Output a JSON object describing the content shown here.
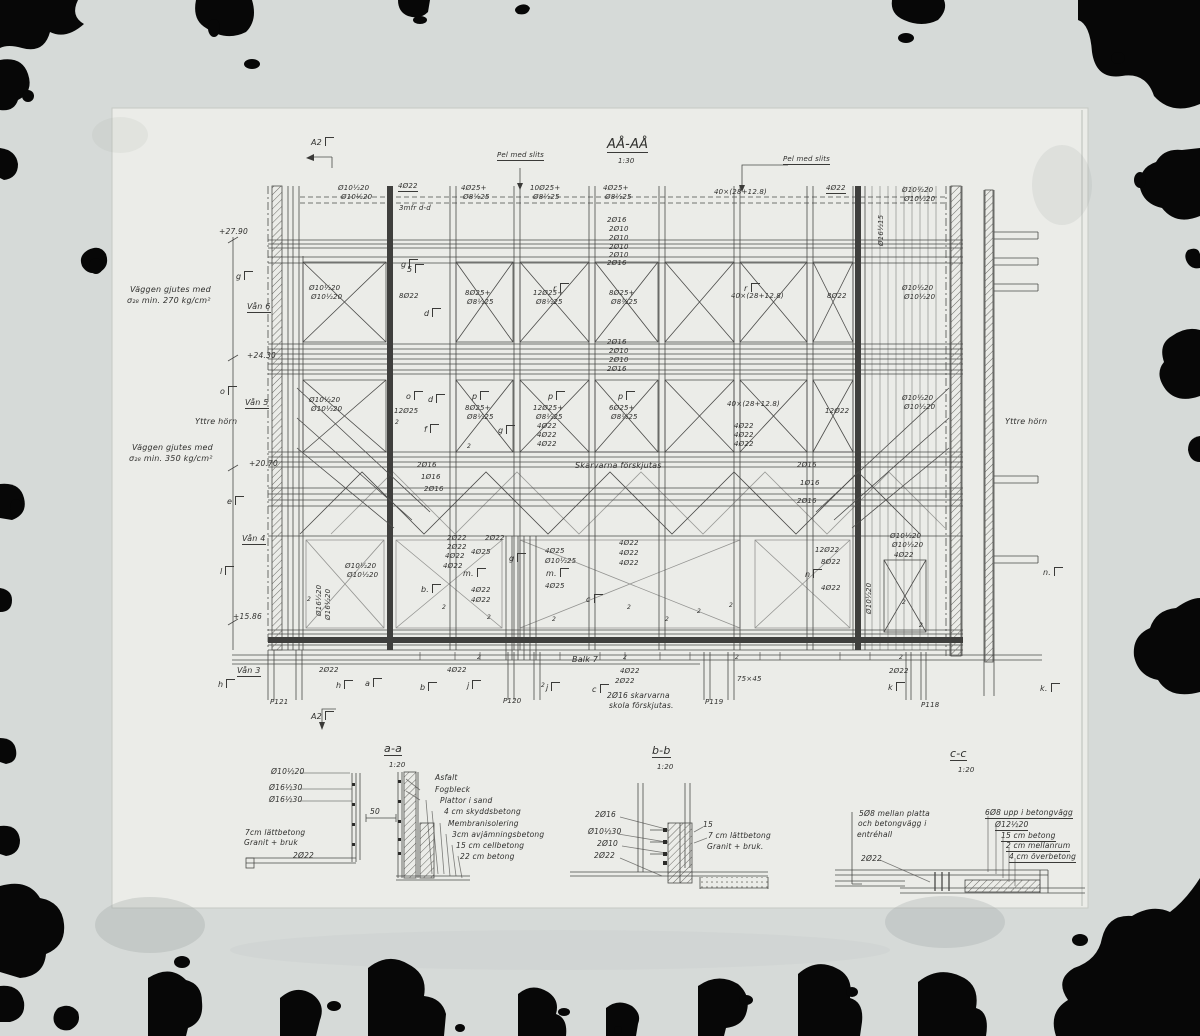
{
  "main": {
    "title": "AÅ-AÅ",
    "scale": "1:30",
    "pel_left": "Pel med slits",
    "pel_right": "Pel med slits",
    "note270_1": "Väggen gjutes med",
    "note270_2": "σ₂₈ min. 270 kg/cm²",
    "note350_1": "Väggen gjutes med",
    "note350_2": "σ₂₈ min. 350 kg/cm²",
    "yttre_left": "Yttre hörn",
    "yttre_right": "Yttre hörn",
    "skarv": "Skarvarna förskjutas",
    "balk": "Balk 7",
    "balk_note1": "2Ø16 skarvarna",
    "balk_note2": "skola förskjutas.",
    "balk_dim": "75×45",
    "elevations": [
      "+27.90",
      "+24.30",
      "+20.70",
      "+15.86"
    ],
    "floors": [
      "Vån 6",
      "Vån 5",
      "Vån 4",
      "Vån 3"
    ],
    "piers": [
      "P121",
      "P120",
      "P119",
      "P118"
    ],
    "markers": [
      "A2",
      "A2",
      "g",
      "o",
      "e",
      "l",
      "h",
      "h",
      "a",
      "b",
      "j",
      "j",
      "c",
      "k",
      "k.",
      "n",
      "n.",
      "g",
      "d",
      "r",
      "r",
      "o",
      "d",
      "p",
      "p",
      "p",
      "f",
      "g",
      "m.",
      "m.",
      "b.",
      "c",
      "g",
      "5"
    ],
    "ann": [
      "Ø10½20",
      "Ø10½20",
      "4Ø22",
      "3mfr d-d",
      "4Ø25+",
      "Ø8½25",
      "10Ø25+",
      "Ø8½25",
      "4Ø25+",
      "Ø8½25",
      "40×(28+12.8)",
      "4Ø22",
      "Ø10½20",
      "Ø10½20",
      "2Ø16",
      "2Ø10",
      "2Ø10",
      "2Ø10",
      "2Ø10",
      "2Ø16",
      "Ø10½20",
      "Ø10½20",
      "8Ø22",
      "8Ø25+",
      "Ø8½25",
      "12Ø25+",
      "Ø8½25",
      "8Ø25+",
      "Ø8½25",
      "40×(28+12.8)",
      "8Ø22",
      "Ø10½20",
      "Ø10½20",
      "2Ø16",
      "2Ø10",
      "2Ø10",
      "2Ø16",
      "Ø10½20",
      "Ø10½20",
      "12Ø25",
      "8Ø25+",
      "Ø8½25",
      "12Ø25+",
      "Ø8½25",
      "4Ø22",
      "4Ø22",
      "4Ø22",
      "6Ø25+",
      "Ø8½25",
      "40×(28+12.8)",
      "12Ø22",
      "Ø10½20",
      "Ø10½20",
      "4Ø22",
      "4Ø22",
      "4Ø22",
      "2Ø16",
      "1Ø16",
      "2Ø16",
      "2Ø16",
      "1Ø16",
      "2Ø16",
      "2Ø22",
      "2Ø22",
      "4Ø22",
      "4Ø22",
      "2Ø22",
      "4Ø25",
      "4Ø25",
      "Ø10½25",
      "4Ø25",
      "4Ø22",
      "4Ø22",
      "4Ø22",
      "4Ø22",
      "4Ø22",
      "12Ø22",
      "8Ø22",
      "4Ø22",
      "Ø10½20",
      "Ø10½20",
      "4Ø22",
      "Ø10½20",
      "Ø10½20",
      "2Ø22",
      "4Ø22",
      "2Ø22",
      "4Ø22",
      "2Ø22",
      "Ø16½20",
      "Ø16½20",
      "Ø16½15",
      "Ø10½20",
      "2",
      "2",
      "2",
      "2",
      "2",
      "2",
      "2",
      "2",
      "2",
      "2",
      "2",
      "2",
      "2",
      "2",
      "2",
      "2",
      "2"
    ]
  },
  "details": {
    "a": {
      "title": "a-a",
      "scale": "1:20",
      "left": [
        "Ø10½20",
        "Ø16½30",
        "Ø16½30",
        "50",
        "7cm lättbetong",
        "Granit + bruk",
        "2Ø22"
      ],
      "right": [
        "Asfalt",
        "Fogbleck",
        "Plattor i sand",
        "4 cm skyddsbetong",
        "Membranisolering",
        "3cm avjämningsbetong",
        "15 cm cellbetong",
        "22 cm betong"
      ]
    },
    "b": {
      "title": "b-b",
      "scale": "1:20",
      "left": [
        "2Ø16",
        "Ø10½30",
        "2Ø10",
        "2Ø22"
      ],
      "right": [
        "15",
        "7 cm lättbetong",
        "Granit + bruk."
      ]
    },
    "c": {
      "title": "c-c",
      "scale": "1:20",
      "left": [
        "5Ø8 mellan platta",
        "och betongvägg i",
        "entréhall",
        "2Ø22"
      ],
      "right": [
        "6Ø8 upp i betongvägg",
        "Ø12½20",
        "15 cm betong",
        "2 cm mellanrum",
        "4 cm överbetong"
      ]
    }
  }
}
